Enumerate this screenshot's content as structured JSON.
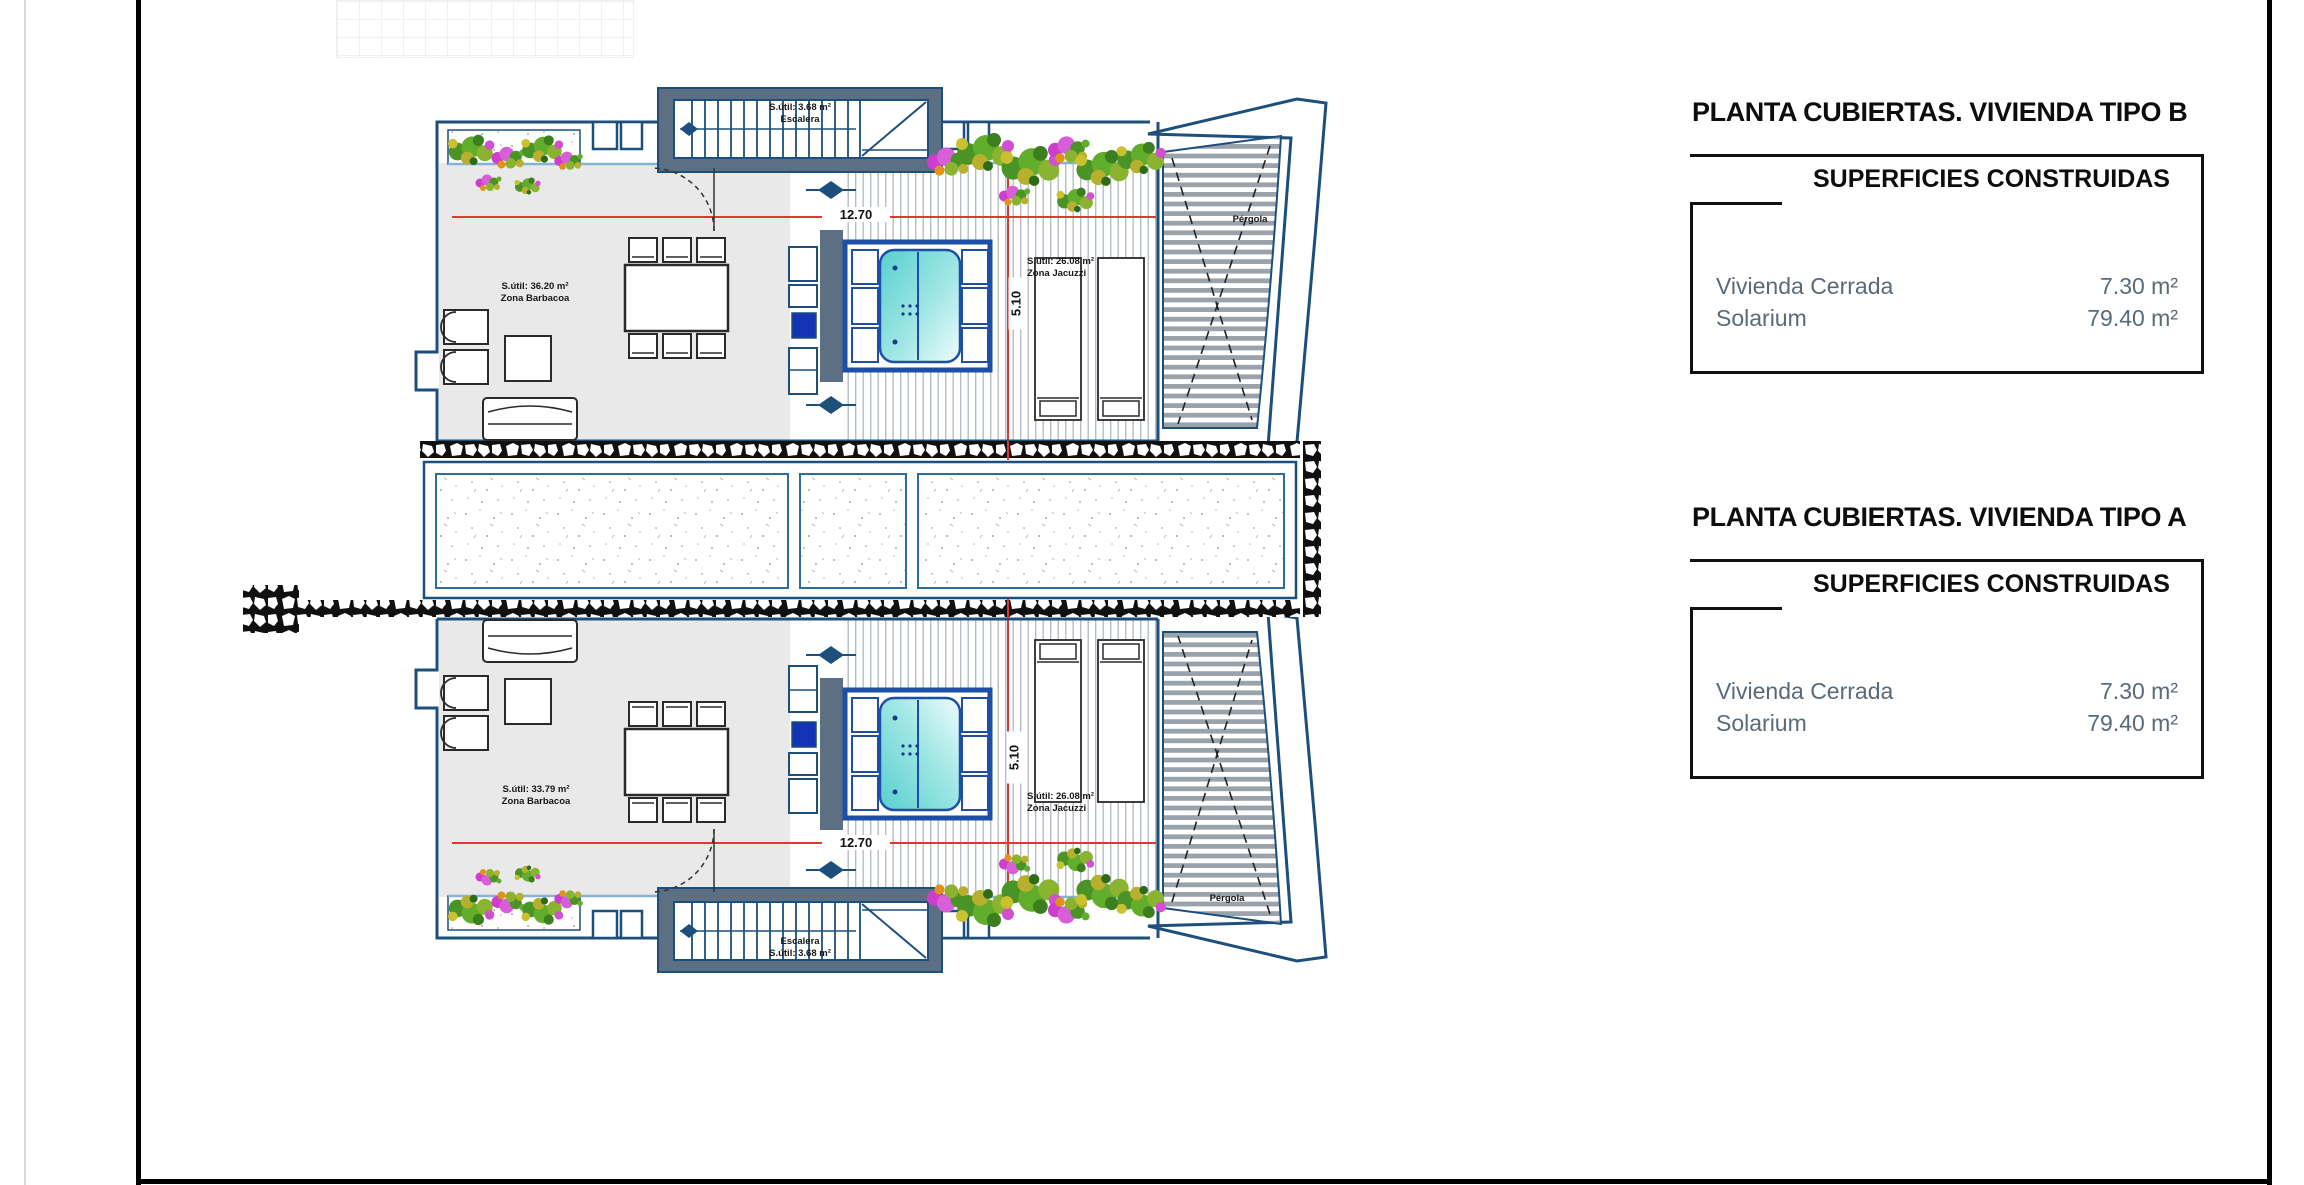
{
  "panels": [
    {
      "title": "PLANTA CUBIERTAS. VIVIENDA TIPO B",
      "subtitle": "SUPERFICIES CONSTRUIDAS",
      "rows": [
        {
          "label": "Vivienda Cerrada",
          "value": "7.30 m²"
        },
        {
          "label": "Solarium",
          "value": "79.40 m²"
        }
      ]
    },
    {
      "title": "PLANTA CUBIERTAS. VIVIENDA TIPO A",
      "subtitle": "SUPERFICIES CONSTRUIDAS",
      "rows": [
        {
          "label": "Vivienda Cerrada",
          "value": "7.30 m²"
        },
        {
          "label": "Solarium",
          "value": "79.40 m²"
        }
      ]
    }
  ],
  "plan": {
    "top_unit": {
      "stair_line1": "S.útil: 3.68 m²",
      "stair_line2": "Escalera",
      "barbecue_area": "S.útil: 36.20 m²",
      "barbecue_name": "Zona Barbacoa",
      "jacuzzi_area": "S.útil: 26.08 m²",
      "jacuzzi_name": "Zona Jacuzzi",
      "pergola": "Pérgola",
      "width_dim": "12.70",
      "height_dim": "5.10"
    },
    "bottom_unit": {
      "stair_line1": "Escalera",
      "stair_line2": "S.útil: 3.68 m²",
      "barbecue_area": "S.útil: 33.79 m²",
      "barbecue_name": "Zona Barbacoa",
      "jacuzzi_area": "S.útil: 26.08 m²",
      "jacuzzi_name": "Zona Jacuzzi",
      "pergola": "Pérgola",
      "width_dim": "12.70",
      "height_dim": "5.10"
    }
  },
  "colors": {
    "wall_blue": "#1c4f7c",
    "light_blue": "#85b2d6",
    "slate": "#5d6f83",
    "floor_gray": "#e9e9e9",
    "dim_red": "#d93a31",
    "water_teal": "#6fd6d4",
    "fixture_blue": "#1533b5",
    "muted_text": "#5a6a79"
  }
}
